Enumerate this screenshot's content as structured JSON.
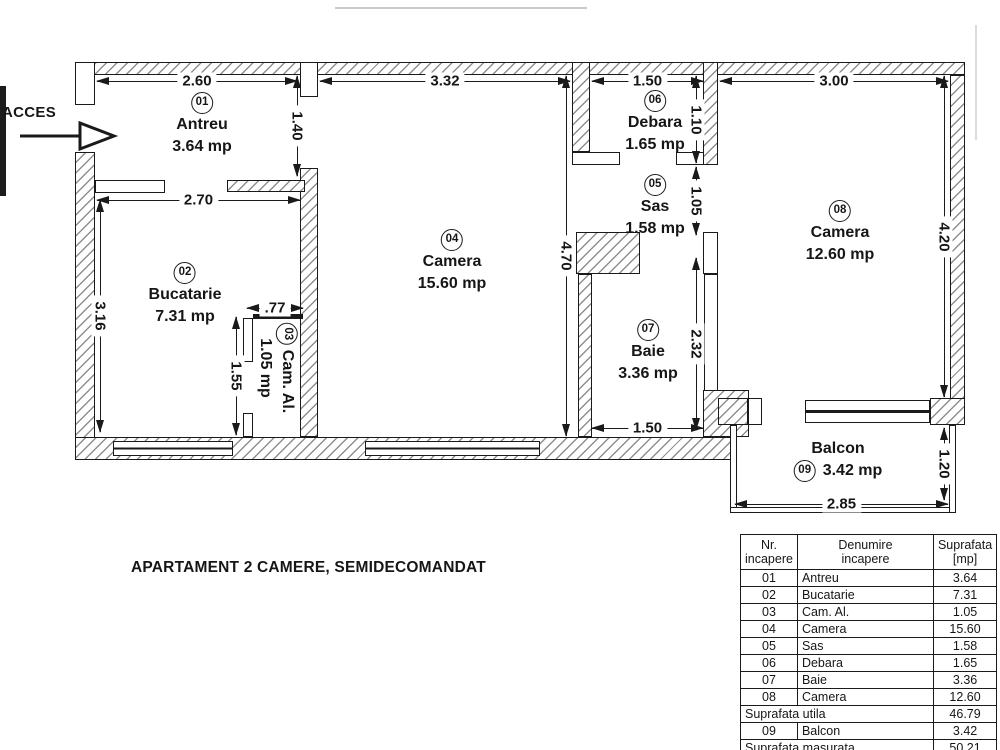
{
  "title": "APARTAMENT 2 CAMERE, SEMIDECOMANDAT",
  "acces_label": "ACCES",
  "icons": {
    "acces_arrow": "right-arrow"
  },
  "colors": {
    "line": "#1a1a1a",
    "background": "#ffffff"
  },
  "rooms": {
    "antreu": {
      "num": "01",
      "name": "Antreu",
      "area": "3.64 mp"
    },
    "bucatarie": {
      "num": "02",
      "name": "Bucatarie",
      "area": "7.31 mp"
    },
    "cam_al": {
      "num": "03",
      "name": "Cam. Al.",
      "area": "1.05 mp"
    },
    "camera4": {
      "num": "04",
      "name": "Camera",
      "area": "15.60 mp"
    },
    "sas": {
      "num": "05",
      "name": "Sas",
      "area": "1.58 mp"
    },
    "debara": {
      "num": "06",
      "name": "Debara",
      "area": "1.65 mp"
    },
    "baie": {
      "num": "07",
      "name": "Baie",
      "area": "3.36 mp"
    },
    "camera8": {
      "num": "08",
      "name": "Camera",
      "area": "12.60 mp"
    },
    "balcon": {
      "num": "09",
      "name": "Balcon",
      "area": "3.42 mp"
    }
  },
  "dimensions": {
    "antreu_w": "2.60",
    "camera4_w": "3.32",
    "debara_w": "1.50",
    "camera8_w": "3.00",
    "bucatarie_w": "2.70",
    "cam_al_w": ".77",
    "baie_w": "1.50",
    "balcon_w": "2.85",
    "antreu_h": "1.40",
    "bucatarie_h": "3.16",
    "cam_al_h": "1.55",
    "camera4_h": "4.70",
    "debara_h": "1.10",
    "sas_h": "1.05",
    "baie_h": "2.32",
    "camera8_h": "4.20",
    "balcon_h": "1.20"
  },
  "table": {
    "headers": [
      {
        "line1": "Nr.",
        "line2": "incapere"
      },
      {
        "line1": "Denumire",
        "line2": "incapere"
      },
      {
        "line1": "Suprafata",
        "line2": "[mp]"
      }
    ],
    "rows": [
      {
        "nr": "01",
        "name": "Antreu",
        "area": "3.64"
      },
      {
        "nr": "02",
        "name": "Bucatarie",
        "area": "7.31"
      },
      {
        "nr": "03",
        "name": "Cam. Al.",
        "area": "1.05"
      },
      {
        "nr": "04",
        "name": "Camera",
        "area": "15.60"
      },
      {
        "nr": "05",
        "name": "Sas",
        "area": "1.58"
      },
      {
        "nr": "06",
        "name": "Debara",
        "area": "1.65"
      },
      {
        "nr": "07",
        "name": "Baie",
        "area": "3.36"
      },
      {
        "nr": "08",
        "name": "Camera",
        "area": "12.60"
      },
      {
        "span": "Suprafata utila",
        "area": "46.79"
      },
      {
        "nr": "09",
        "name": "Balcon",
        "area": "3.42"
      },
      {
        "span": "Suprafata masurata",
        "area": "50.21"
      }
    ]
  }
}
